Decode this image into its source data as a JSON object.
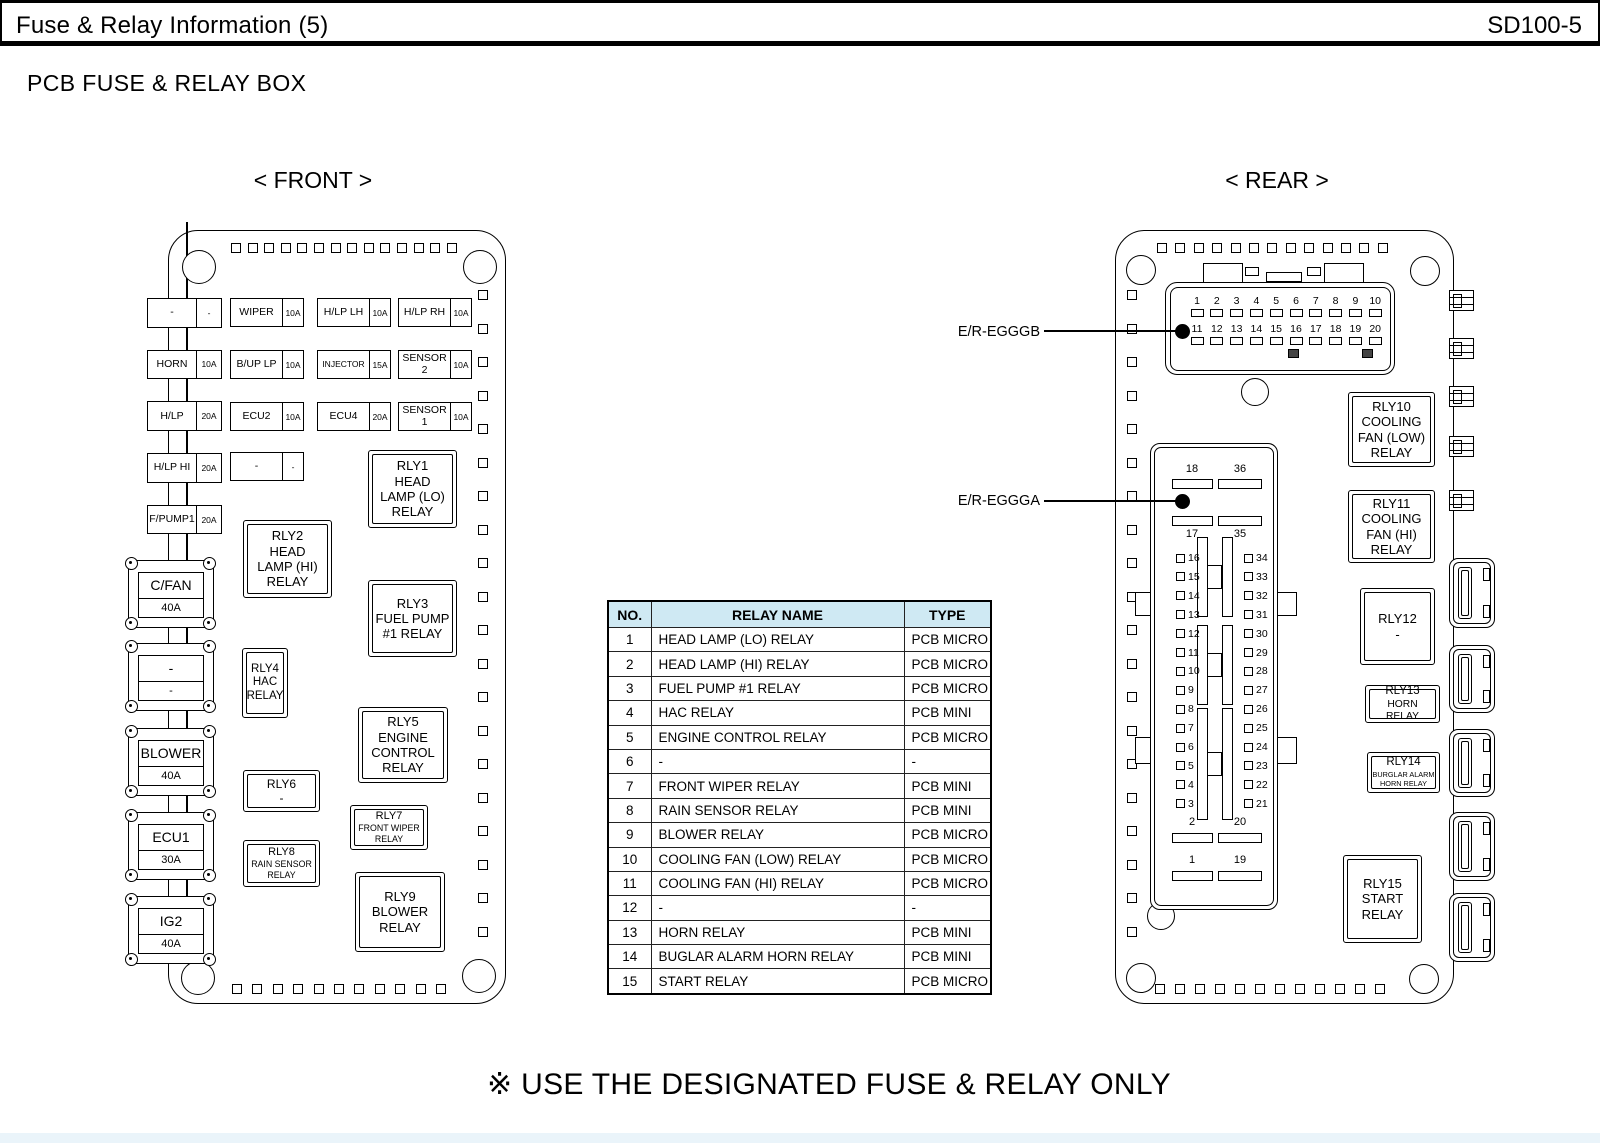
{
  "header": {
    "title": "Fuse & Relay Information (5)",
    "code": "SD100-5"
  },
  "page_title": "PCB FUSE & RELAY BOX",
  "front": {
    "label": "< FRONT >",
    "left_fuses": [
      {
        "name": "-",
        "rating": "-"
      },
      {
        "name": "HORN",
        "rating": "10A"
      },
      {
        "name": "H/LP",
        "rating": "20A"
      },
      {
        "name": "H/LP HI",
        "rating": "20A"
      },
      {
        "name": "F/PUMP1",
        "rating": "20A"
      }
    ],
    "grid_fuses": [
      {
        "name": "WIPER",
        "rating": "10A",
        "row": 0,
        "col": 0
      },
      {
        "name": "H/LP LH",
        "rating": "10A",
        "row": 0,
        "col": 1
      },
      {
        "name": "H/LP RH",
        "rating": "10A",
        "row": 0,
        "col": 2
      },
      {
        "name": "B/UP LP",
        "rating": "10A",
        "row": 1,
        "col": 0
      },
      {
        "name": "INJECTOR",
        "rating": "15A",
        "row": 1,
        "col": 1
      },
      {
        "name": "SENSOR 2",
        "rating": "10A",
        "row": 1,
        "col": 2
      },
      {
        "name": "ECU2",
        "rating": "10A",
        "row": 2,
        "col": 0
      },
      {
        "name": "ECU4",
        "rating": "20A",
        "row": 2,
        "col": 1
      },
      {
        "name": "SENSOR 1",
        "rating": "10A",
        "row": 2,
        "col": 2
      },
      {
        "name": "-",
        "rating": "-",
        "row": 3,
        "col": 0
      }
    ],
    "maxi_fuses": [
      {
        "name": "C/FAN",
        "rating": "40A"
      },
      {
        "name": "-",
        "rating": "-"
      },
      {
        "name": "BLOWER",
        "rating": "40A"
      },
      {
        "name": "ECU1",
        "rating": "30A"
      },
      {
        "name": "IG2",
        "rating": "40A"
      }
    ],
    "relays": [
      {
        "id": "RLY1",
        "sub": "HEAD\nLAMP (LO)\nRELAY"
      },
      {
        "id": "RLY2",
        "sub": "HEAD\nLAMP (HI)\nRELAY"
      },
      {
        "id": "RLY3",
        "sub": "FUEL PUMP\n#1 RELAY"
      },
      {
        "id": "RLY4",
        "sub": "HAC\nRELAY"
      },
      {
        "id": "RLY5",
        "sub": "ENGINE\nCONTROL\nRELAY"
      },
      {
        "id": "RLY6",
        "sub": "-"
      },
      {
        "id": "RLY7",
        "sub": "FRONT WIPER\nRELAY"
      },
      {
        "id": "RLY8",
        "sub": "RAIN SENSOR\nRELAY"
      },
      {
        "id": "RLY9",
        "sub": "BLOWER\nRELAY"
      }
    ]
  },
  "rear": {
    "label": "< REAR >",
    "connector_b": {
      "callout": "E/R-EGGGB",
      "pins_row1": [
        "1",
        "2",
        "3",
        "4",
        "5",
        "6",
        "7",
        "8",
        "9",
        "10"
      ],
      "pins_row2": [
        "11",
        "12",
        "13",
        "14",
        "15",
        "16",
        "17",
        "18",
        "19",
        "20"
      ]
    },
    "connector_a": {
      "callout": "E/R-EGGGA",
      "top_labels": [
        "18",
        "36"
      ],
      "upper_labels": [
        "17",
        "35"
      ],
      "left_pins": [
        "16",
        "15",
        "14",
        "13",
        "12",
        "11",
        "10",
        "9",
        "8",
        "7",
        "6",
        "5",
        "4",
        "3"
      ],
      "right_pins": [
        "34",
        "33",
        "32",
        "31",
        "30",
        "29",
        "28",
        "27",
        "26",
        "25",
        "24",
        "23",
        "22",
        "21"
      ],
      "lower_labels": [
        "2",
        "20"
      ],
      "bottom_labels": [
        "1",
        "19"
      ]
    },
    "relays": [
      {
        "id": "RLY10",
        "sub": "COOLING\nFAN (LOW)\nRELAY"
      },
      {
        "id": "RLY11",
        "sub": "COOLING\nFAN (HI)\nRELAY"
      },
      {
        "id": "RLY12",
        "sub": "-"
      },
      {
        "id": "RLY13",
        "sub": "HORN RELAY"
      },
      {
        "id": "RLY14",
        "sub": "BURGLAR ALARM\nHORN RELAY"
      },
      {
        "id": "RLY15",
        "sub": "START\nRELAY"
      }
    ]
  },
  "table": {
    "headers": [
      "NO.",
      "RELAY NAME",
      "TYPE"
    ],
    "rows": [
      [
        "1",
        "HEAD LAMP (LO) RELAY",
        "PCB MICRO"
      ],
      [
        "2",
        "HEAD LAMP (HI) RELAY",
        "PCB MICRO"
      ],
      [
        "3",
        "FUEL PUMP #1 RELAY",
        "PCB MICRO"
      ],
      [
        "4",
        "HAC RELAY",
        "PCB MINI"
      ],
      [
        "5",
        "ENGINE CONTROL RELAY",
        "PCB MICRO"
      ],
      [
        "6",
        "-",
        "-"
      ],
      [
        "7",
        "FRONT WIPER RELAY",
        "PCB MINI"
      ],
      [
        "8",
        "RAIN SENSOR RELAY",
        "PCB MINI"
      ],
      [
        "9",
        "BLOWER RELAY",
        "PCB MICRO"
      ],
      [
        "10",
        "COOLING FAN (LOW) RELAY",
        "PCB MICRO"
      ],
      [
        "11",
        "COOLING FAN (HI) RELAY",
        "PCB MICRO"
      ],
      [
        "12",
        "-",
        "-"
      ],
      [
        "13",
        "HORN RELAY",
        "PCB MINI"
      ],
      [
        "14",
        "BUGLAR ALARM HORN RELAY",
        "PCB MINI"
      ],
      [
        "15",
        "START RELAY",
        "PCB MICRO"
      ]
    ]
  },
  "footer_note": "※ USE THE DESIGNATED FUSE & RELAY ONLY",
  "colors": {
    "table_header_bg": "#cfe9f3",
    "ink": "#000000"
  }
}
